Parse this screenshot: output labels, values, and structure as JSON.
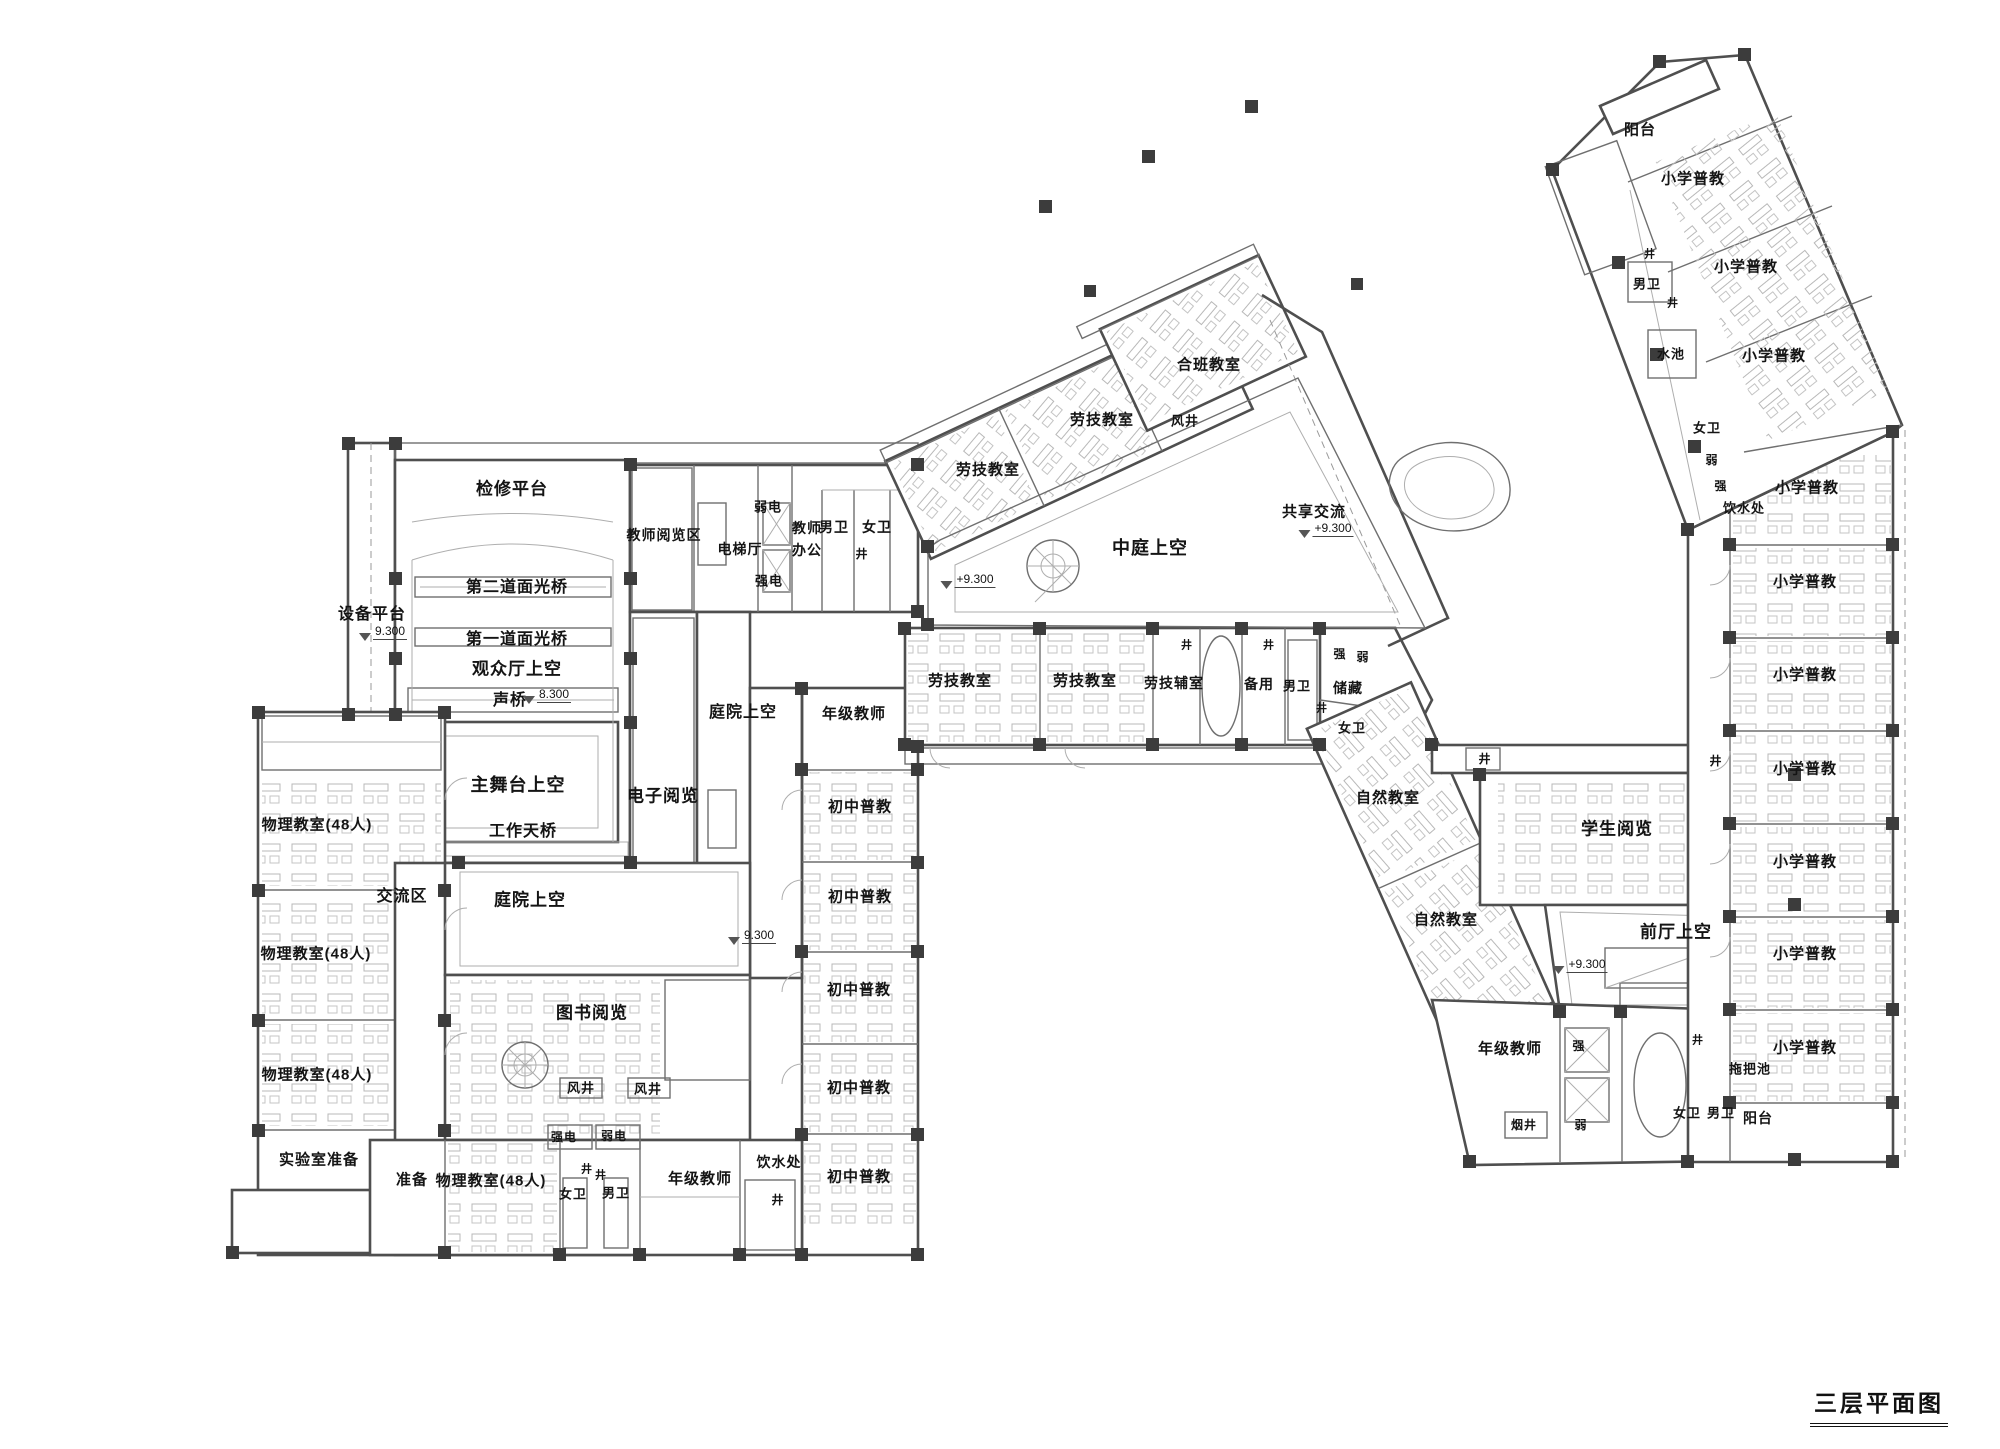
{
  "title": {
    "text": "三层平面图"
  },
  "colors": {
    "line": "#4f4f4f",
    "column": "#3c3c3c",
    "text": "#141414",
    "bg": "#ffffff"
  },
  "plan": {
    "labels": [
      {
        "t": "检修平台",
        "x": 512,
        "y": 489,
        "fs": 17
      },
      {
        "t": "设备平台",
        "x": 372,
        "y": 615,
        "fs": 16
      },
      {
        "t": "9.300",
        "x": 383,
        "y": 633,
        "fs": 12,
        "e": 1
      },
      {
        "t": "第二道面光桥",
        "x": 517,
        "y": 588,
        "fs": 16
      },
      {
        "t": "第一道面光桥",
        "x": 517,
        "y": 640,
        "fs": 16
      },
      {
        "t": "观众厅上空",
        "x": 517,
        "y": 669,
        "fs": 17
      },
      {
        "t": "声桥",
        "x": 510,
        "y": 701,
        "fs": 16
      },
      {
        "t": "8.300",
        "x": 547,
        "y": 696,
        "fs": 12,
        "e": 1
      },
      {
        "t": "主舞台上空",
        "x": 518,
        "y": 785,
        "fs": 18
      },
      {
        "t": "工作天桥",
        "x": 523,
        "y": 832,
        "fs": 16
      },
      {
        "t": "交流区",
        "x": 402,
        "y": 897,
        "fs": 16
      },
      {
        "t": "庭院上空",
        "x": 743,
        "y": 713,
        "fs": 16
      },
      {
        "t": "电子阅览",
        "x": 663,
        "y": 796,
        "fs": 17
      },
      {
        "t": "教师阅览区",
        "x": 664,
        "y": 535,
        "fs": 14
      },
      {
        "t": "弱电",
        "x": 768,
        "y": 507,
        "fs": 13
      },
      {
        "t": "电梯厅",
        "x": 740,
        "y": 549,
        "fs": 14
      },
      {
        "t": "强电",
        "x": 769,
        "y": 581,
        "fs": 13
      },
      {
        "t": "教师",
        "x": 807,
        "y": 528,
        "fs": 14
      },
      {
        "t": "办公",
        "x": 807,
        "y": 550,
        "fs": 14
      },
      {
        "t": "男卫",
        "x": 834,
        "y": 527,
        "fs": 14
      },
      {
        "t": "女卫",
        "x": 877,
        "y": 527,
        "fs": 14
      },
      {
        "t": "井",
        "x": 862,
        "y": 554,
        "fs": 12
      },
      {
        "t": "物理教室(48人)",
        "x": 317,
        "y": 825,
        "fs": 15
      },
      {
        "t": "物理教室(48人)",
        "x": 316,
        "y": 954,
        "fs": 15
      },
      {
        "t": "物理教室(48人)",
        "x": 317,
        "y": 1075,
        "fs": 15
      },
      {
        "t": "实验室准备",
        "x": 319,
        "y": 1160,
        "fs": 15
      },
      {
        "t": "准备",
        "x": 412,
        "y": 1180,
        "fs": 15
      },
      {
        "t": "物理教室(48人)",
        "x": 491,
        "y": 1181,
        "fs": 15
      },
      {
        "t": "强电",
        "x": 564,
        "y": 1137,
        "fs": 12
      },
      {
        "t": "弱电",
        "x": 614,
        "y": 1136,
        "fs": 12
      },
      {
        "t": "井",
        "x": 587,
        "y": 1170,
        "fs": 11
      },
      {
        "t": "井",
        "x": 601,
        "y": 1176,
        "fs": 11
      },
      {
        "t": "女卫",
        "x": 573,
        "y": 1194,
        "fs": 13
      },
      {
        "t": "男卫",
        "x": 616,
        "y": 1193,
        "fs": 13
      },
      {
        "t": "年级教师",
        "x": 700,
        "y": 1179,
        "fs": 15
      },
      {
        "t": "饮水处",
        "x": 779,
        "y": 1162,
        "fs": 14
      },
      {
        "t": "井",
        "x": 778,
        "y": 1200,
        "fs": 12
      },
      {
        "t": "风井",
        "x": 581,
        "y": 1088,
        "fs": 13
      },
      {
        "t": "风井",
        "x": 648,
        "y": 1089,
        "fs": 13
      },
      {
        "t": "图书阅览",
        "x": 592,
        "y": 1013,
        "fs": 17
      },
      {
        "t": "庭院上空",
        "x": 530,
        "y": 900,
        "fs": 17
      },
      {
        "t": "年级教师",
        "x": 854,
        "y": 714,
        "fs": 15
      },
      {
        "t": "初中普教",
        "x": 860,
        "y": 807,
        "fs": 15
      },
      {
        "t": "初中普教",
        "x": 860,
        "y": 897,
        "fs": 15
      },
      {
        "t": "初中普教",
        "x": 859,
        "y": 990,
        "fs": 15
      },
      {
        "t": "初中普教",
        "x": 859,
        "y": 1088,
        "fs": 15
      },
      {
        "t": "初中普教",
        "x": 859,
        "y": 1177,
        "fs": 15
      },
      {
        "t": "9.300",
        "x": 752,
        "y": 937,
        "fs": 12,
        "e": 1
      },
      {
        "t": "劳技教室",
        "x": 988,
        "y": 470,
        "fs": 15
      },
      {
        "t": "劳技教室",
        "x": 1102,
        "y": 420,
        "fs": 15
      },
      {
        "t": "合班教室",
        "x": 1209,
        "y": 365,
        "fs": 15
      },
      {
        "t": "风井",
        "x": 1185,
        "y": 421,
        "fs": 13
      },
      {
        "t": "中庭上空",
        "x": 1150,
        "y": 548,
        "fs": 18
      },
      {
        "t": "共享交流",
        "x": 1314,
        "y": 512,
        "fs": 15
      },
      {
        "t": "+9.300",
        "x": 1326,
        "y": 530,
        "fs": 12,
        "e": 1
      },
      {
        "t": "+9.300",
        "x": 968,
        "y": 581,
        "fs": 12,
        "e": 1
      },
      {
        "t": "劳技教室",
        "x": 960,
        "y": 681,
        "fs": 15
      },
      {
        "t": "劳技教室",
        "x": 1085,
        "y": 681,
        "fs": 15
      },
      {
        "t": "劳技辅室",
        "x": 1174,
        "y": 683,
        "fs": 14
      },
      {
        "t": "井",
        "x": 1187,
        "y": 646,
        "fs": 11
      },
      {
        "t": "井",
        "x": 1269,
        "y": 646,
        "fs": 11
      },
      {
        "t": "备用",
        "x": 1259,
        "y": 684,
        "fs": 14
      },
      {
        "t": "男卫",
        "x": 1297,
        "y": 686,
        "fs": 13
      },
      {
        "t": "储藏",
        "x": 1348,
        "y": 688,
        "fs": 14
      },
      {
        "t": "强",
        "x": 1340,
        "y": 654,
        "fs": 12
      },
      {
        "t": "弱",
        "x": 1363,
        "y": 657,
        "fs": 12
      },
      {
        "t": "井",
        "x": 1322,
        "y": 709,
        "fs": 11
      },
      {
        "t": "女卫",
        "x": 1352,
        "y": 728,
        "fs": 13
      },
      {
        "t": "自然教室",
        "x": 1388,
        "y": 798,
        "fs": 15
      },
      {
        "t": "自然教室",
        "x": 1446,
        "y": 920,
        "fs": 15
      },
      {
        "t": "学生阅览",
        "x": 1617,
        "y": 829,
        "fs": 17
      },
      {
        "t": "前厅上空",
        "x": 1676,
        "y": 932,
        "fs": 17
      },
      {
        "t": "+9.300",
        "x": 1580,
        "y": 966,
        "fs": 12,
        "e": 1
      },
      {
        "t": "井",
        "x": 1485,
        "y": 759,
        "fs": 12
      },
      {
        "t": "井",
        "x": 1716,
        "y": 761,
        "fs": 12
      },
      {
        "t": "年级教师",
        "x": 1510,
        "y": 1049,
        "fs": 15
      },
      {
        "t": "强",
        "x": 1579,
        "y": 1046,
        "fs": 12
      },
      {
        "t": "弱",
        "x": 1581,
        "y": 1125,
        "fs": 12
      },
      {
        "t": "烟井",
        "x": 1524,
        "y": 1125,
        "fs": 12
      },
      {
        "t": "女卫",
        "x": 1687,
        "y": 1113,
        "fs": 13
      },
      {
        "t": "男卫",
        "x": 1721,
        "y": 1113,
        "fs": 13
      },
      {
        "t": "井",
        "x": 1698,
        "y": 1041,
        "fs": 11
      },
      {
        "t": "拖把池",
        "x": 1750,
        "y": 1069,
        "fs": 13
      },
      {
        "t": "阳台",
        "x": 1758,
        "y": 1118,
        "fs": 14
      },
      {
        "t": "阳台",
        "x": 1640,
        "y": 130,
        "fs": 15
      },
      {
        "t": "小学普教",
        "x": 1693,
        "y": 179,
        "fs": 15
      },
      {
        "t": "小学普教",
        "x": 1746,
        "y": 267,
        "fs": 15
      },
      {
        "t": "小学普教",
        "x": 1774,
        "y": 356,
        "fs": 15
      },
      {
        "t": "井",
        "x": 1650,
        "y": 255,
        "fs": 11
      },
      {
        "t": "男卫",
        "x": 1647,
        "y": 284,
        "fs": 13
      },
      {
        "t": "井",
        "x": 1673,
        "y": 304,
        "fs": 11
      },
      {
        "t": "水池",
        "x": 1671,
        "y": 354,
        "fs": 13
      },
      {
        "t": "女卫",
        "x": 1707,
        "y": 428,
        "fs": 13
      },
      {
        "t": "弱",
        "x": 1712,
        "y": 460,
        "fs": 12
      },
      {
        "t": "强",
        "x": 1721,
        "y": 486,
        "fs": 12
      },
      {
        "t": "饮水处",
        "x": 1744,
        "y": 508,
        "fs": 13
      },
      {
        "t": "小学普教",
        "x": 1807,
        "y": 488,
        "fs": 15
      },
      {
        "t": "小学普教",
        "x": 1805,
        "y": 582,
        "fs": 15
      },
      {
        "t": "小学普教",
        "x": 1805,
        "y": 675,
        "fs": 15
      },
      {
        "t": "小学普教",
        "x": 1805,
        "y": 769,
        "fs": 15
      },
      {
        "t": "小学普教",
        "x": 1805,
        "y": 862,
        "fs": 15
      },
      {
        "t": "小学普教",
        "x": 1805,
        "y": 954,
        "fs": 15
      },
      {
        "t": "小学普教",
        "x": 1805,
        "y": 1048,
        "fs": 15
      }
    ]
  }
}
